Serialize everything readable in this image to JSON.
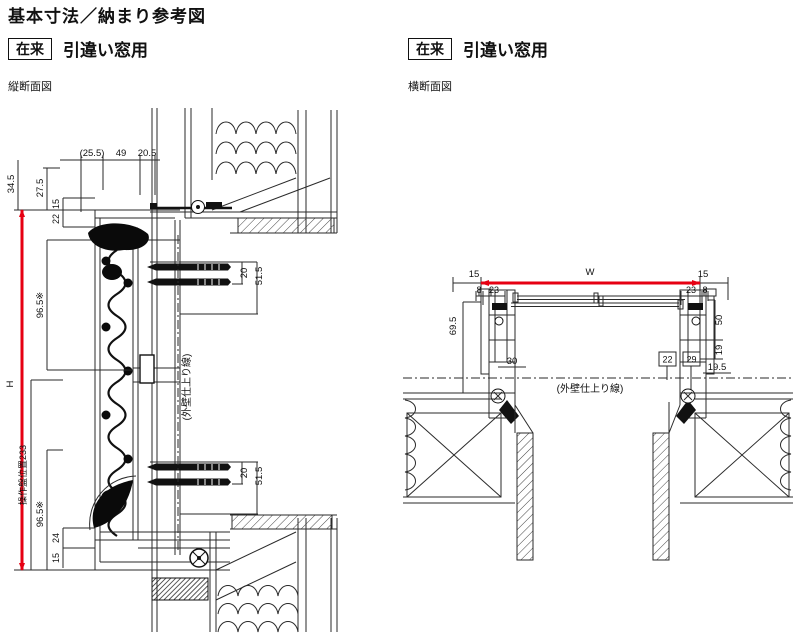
{
  "title": "基本寸法／納まり参考図",
  "colors": {
    "accent_red": "#e60012",
    "ink": "#111111"
  },
  "sections": {
    "vertical": {
      "badge": "在来",
      "heading": "引違い窓用",
      "view_label": "縦断面図",
      "finish_line_label": "(外壁仕上り線)",
      "dims": {
        "top_1": "(25.5)",
        "top_2": "49",
        "top_3": "20.5",
        "left_1": "34.5",
        "left_2": "27.5",
        "left_3": "15",
        "left_4": "22",
        "left_5": "96.5※",
        "height_label": "H",
        "operator_position": "操作盤位置233",
        "left_6": "96.5※",
        "left_7": "24",
        "left_8": "15",
        "screw_top_1": "20",
        "screw_top_2": "51.5",
        "screw_bottom_1": "20",
        "screw_bottom_2": "51.5"
      }
    },
    "horizontal": {
      "badge": "在来",
      "heading": "引違い窓用",
      "view_label": "横断面図",
      "finish_line_label": "(外壁仕上り線)",
      "dims": {
        "width_label": "W",
        "offset_left": "15",
        "offset_right": "15",
        "frame_left_1": "8",
        "frame_left_2": "23",
        "frame_right_1": "23",
        "frame_right_2": "8",
        "depth": "69.5",
        "right_1": "50",
        "right_2": "19",
        "box_1": "22",
        "box_2": "29",
        "right_3": "19.5",
        "center": "30"
      }
    }
  }
}
